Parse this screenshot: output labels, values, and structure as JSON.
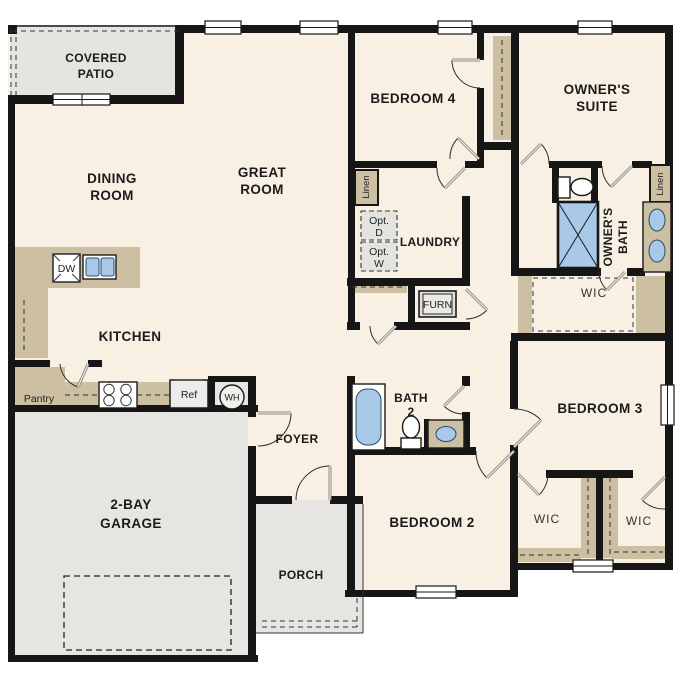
{
  "title": "single-story floor plan",
  "colors": {
    "wall": "#161616",
    "floor": "#f8f0e2",
    "concrete": "#e6e5e1",
    "counter": "#cdbfa2",
    "water_fixture": "#a9c9e8",
    "optional_box": "#e3e3df"
  },
  "rooms": {
    "covered_patio": {
      "l1": "COVERED",
      "l2": "PATIO"
    },
    "dining": {
      "l1": "DINING",
      "l2": "ROOM"
    },
    "great": {
      "l1": "GREAT",
      "l2": "ROOM"
    },
    "kitchen": {
      "l1": "KITCHEN"
    },
    "garage": {
      "l1": "2-BAY",
      "l2": "GARAGE"
    },
    "foyer": {
      "l1": "FOYER"
    },
    "porch": {
      "l1": "PORCH"
    },
    "bedroom4": {
      "l1": "BEDROOM 4"
    },
    "owners_suite": {
      "l1": "OWNER'S",
      "l2": "SUITE"
    },
    "laundry": {
      "l1": "LAUNDRY"
    },
    "bath2": {
      "l1": "BATH",
      "l2": "2"
    },
    "bedroom2": {
      "l1": "BEDROOM 2"
    },
    "bedroom3": {
      "l1": "BEDROOM 3"
    },
    "owners_bath": {
      "l1": "OWNER'S",
      "l2": "BATH"
    },
    "wic_owner": {
      "l1": "WIC"
    },
    "wic_left": {
      "l1": "WIC"
    },
    "wic_right": {
      "l1": "WIC"
    }
  },
  "fixtures": {
    "pantry": "Pantry",
    "ref": "Ref",
    "wh": "WH",
    "dw": "DW",
    "furn": "FURN",
    "linen_laundry": "Linen",
    "linen_owner": "Linen",
    "opt_dryer": {
      "l1": "Opt.",
      "l2": "D"
    },
    "opt_washer": {
      "l1": "Opt.",
      "l2": "W"
    }
  }
}
